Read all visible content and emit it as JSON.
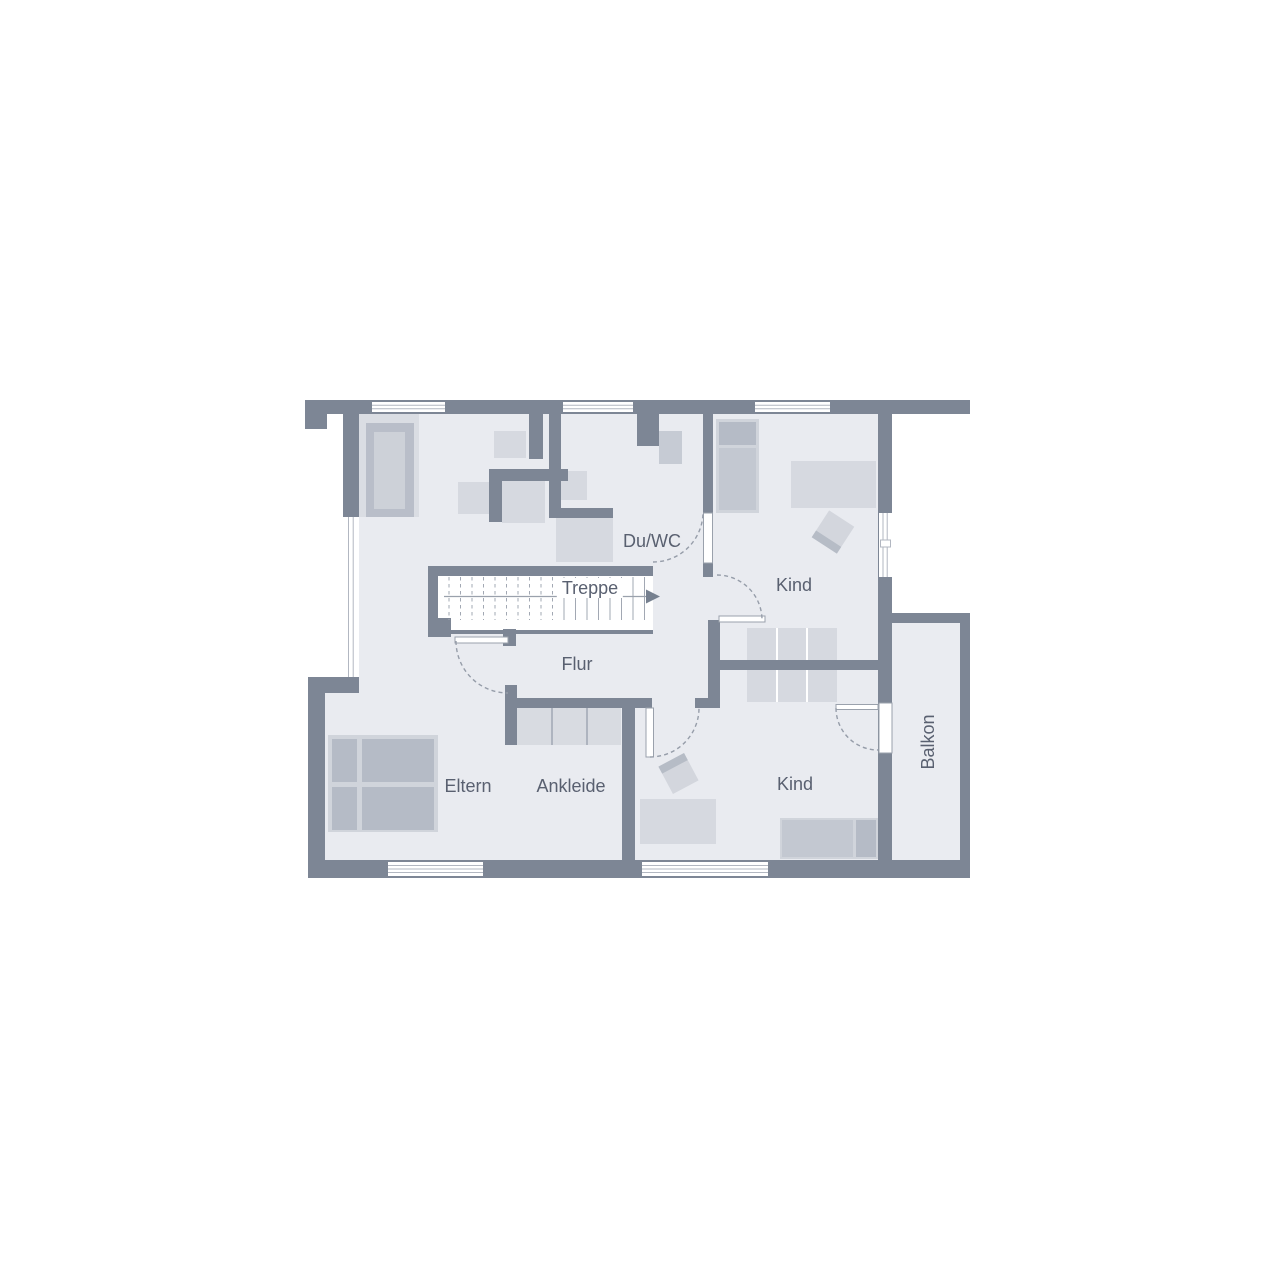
{
  "floorplan": {
    "type": "upper-floor plan",
    "rooms": {
      "du_wc": "Du/WC",
      "treppe": "Treppe",
      "kind_top": "Kind",
      "flur": "Flur",
      "eltern": "Eltern",
      "ankleide": "Ankleide",
      "kind_bottom": "Kind",
      "balkon": "Balkon"
    },
    "stairs": {
      "label": "Treppe",
      "direction": "arrow-right",
      "treads": 18
    },
    "colors": {
      "wall": "#7d8695",
      "floor": "#e9ebf0",
      "furniture_light": "#d6d9e0",
      "furniture_medium": "#c3c8d1",
      "furniture_dark": "#b5bbc6",
      "window_white": "#ffffff",
      "label_text": "#596070",
      "door_arc_dash": "#969da9"
    }
  }
}
